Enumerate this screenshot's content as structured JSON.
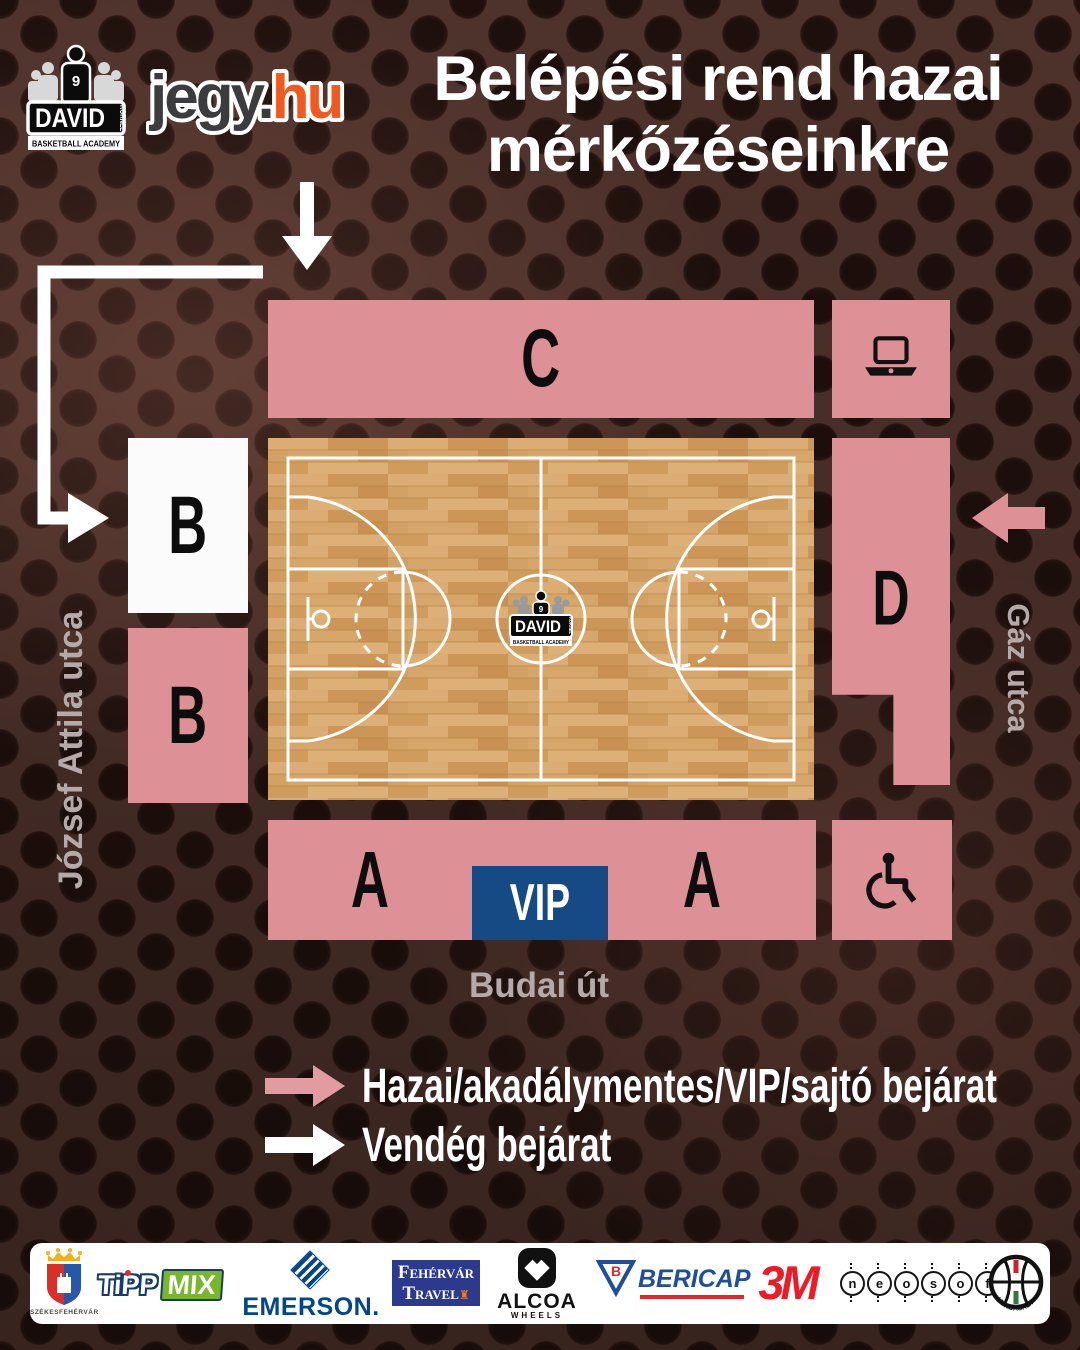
{
  "poster": {
    "title_line1": "Belépési rend hazai",
    "title_line2": "mérkőzéseinkre"
  },
  "logos": {
    "jegy": {
      "part1": "jegy.",
      "part2": "hu"
    },
    "david": {
      "name": "DAVID",
      "surname": "KORNEL",
      "academy": "BASKETBALL ACADEMY",
      "number": "9"
    }
  },
  "map": {
    "section_c": "C",
    "section_b_upper": "B",
    "section_b_lower": "B",
    "section_d": "D",
    "section_a_left": "A",
    "section_a_right": "A",
    "vip": "VIP",
    "street_left": "József Attila utca",
    "street_right": "Gáz utca",
    "street_bottom": "Budai út"
  },
  "legend": {
    "home": "Hazai/akadálymentes/VIP/sajtó bejárat",
    "guest": "Vendég bejárat"
  },
  "sponsors": {
    "szekesfehervar": {
      "caption": "SZÉKESFEHÉRVÁR"
    },
    "tippmix": {
      "part1": "TiPP",
      "part2": "MIX"
    },
    "emerson": {
      "label": "EMERSON."
    },
    "fehervar_travel": {
      "line1_initial": "F",
      "line1_rest": "EHÉRVÁR",
      "line2_initial": "T",
      "line2_rest": "RAVEL",
      "crown": "♜"
    },
    "alcoa": {
      "label": "ALCOA",
      "sub": "WHEELS"
    },
    "bericap": {
      "b": "B",
      "label": "BERICAP"
    },
    "threeM": {
      "label": "3M"
    },
    "neosoft": {
      "letters": [
        "n",
        "e",
        "o",
        "s",
        "o",
        "f",
        "t"
      ]
    },
    "hunbasket": {
      "label": "HUNBASKET"
    }
  },
  "colors": {
    "section_pink": "#de9097",
    "vip_blue": "#164a85",
    "court_wood": "#d2a165",
    "street_text": "#b5aaa9",
    "jegy_orange": "#f1591f",
    "legend_arrow_pink": "#e29ba1",
    "background_brown": "#543730"
  }
}
